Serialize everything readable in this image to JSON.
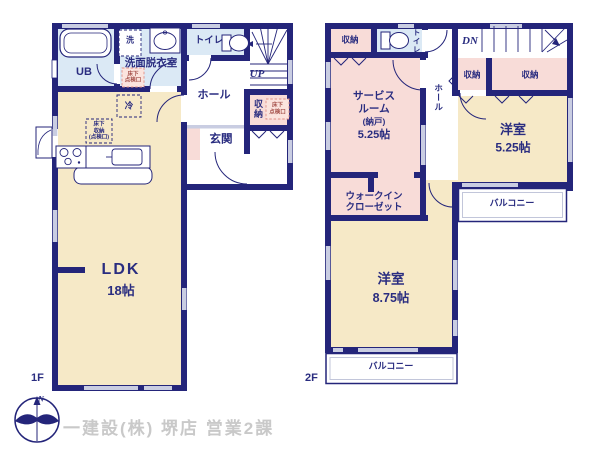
{
  "floor1": {
    "floor_label": "1F",
    "ldk_name": "LDK",
    "ldk_size": "18帖",
    "ub": "UB",
    "washer": "洗",
    "washroom": "洗面脱衣室",
    "toilet": "トイレ",
    "hall": "ホール",
    "stairs_up": "UP",
    "storage": "収納",
    "entrance": "玄関",
    "fridge": "冷",
    "inspection_line1": "床下",
    "inspection_line2": "点検口",
    "underfloor_storage_line1": "床下",
    "underfloor_storage_line2": "収納",
    "underfloor_storage_line3": "(点検口)"
  },
  "floor2": {
    "floor_label": "2F",
    "storage_a": "収納",
    "storage_b": "収納",
    "storage_c": "収納",
    "toilet": "トイレ",
    "stairs_down": "DN",
    "hall": "ホール",
    "service_line1": "サービス",
    "service_line2": "ルーム",
    "service_line3": "(納戸)",
    "service_size": "5.25帖",
    "western_a_name": "洋室",
    "western_a_size": "5.25帖",
    "wic_line1": "ウォークイン",
    "wic_line2": "クローゼット",
    "western_b_name": "洋室",
    "western_b_size": "8.75帖",
    "balcony_right": "バルコニー",
    "balcony_bottom": "バルコニー"
  },
  "compass": {
    "north_label": "N"
  },
  "credit": "一建設(株) 堺店 営業2課",
  "colors": {
    "wall": "#24257a",
    "text": "#2a2d80",
    "room_cream": "#f6e9c7",
    "room_pink": "#f8dcd8",
    "room_blue": "#dbe9f5",
    "inspection_pink": "#fbe4de",
    "inspection_border": "#e09087",
    "window": "#c9cde2",
    "credit_text": "#c9c9c9"
  }
}
